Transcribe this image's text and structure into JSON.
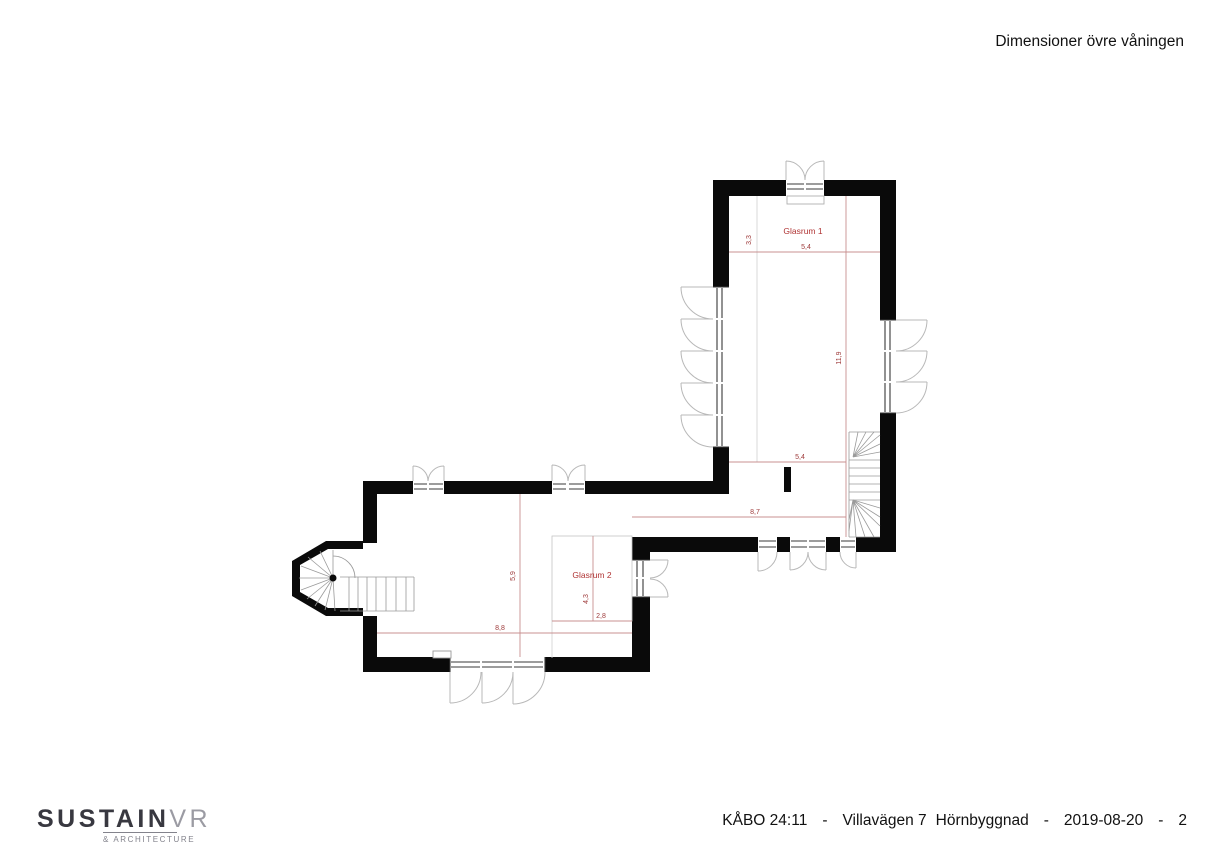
{
  "title": {
    "text": "Dimensioner övre våningen"
  },
  "logo": {
    "primary": "SUSTAIN",
    "secondary": "VR",
    "tagline": "& ARCHITECTURE"
  },
  "footer": {
    "project": "KÅBO 24:11",
    "separator": "-",
    "street": "Villavägen 7",
    "building": "Hörnbyggnad",
    "date": "2019-08-20",
    "page": "2"
  },
  "plan": {
    "rooms": [
      {
        "name": "Glasrum 1"
      },
      {
        "name": "Glasrum 2"
      }
    ],
    "dims": {
      "g1_top_width": "5,4",
      "g1_top_offset": "3,3",
      "g1_length": "11,9",
      "g1_lower_width": "5,4",
      "cross_span": "8,7",
      "west_depth": "5,9",
      "west_width": "8,8",
      "g2_depth": "4,3",
      "g2_width": "2,8"
    },
    "colors": {
      "wall": "#0a0a0a",
      "dimension_line": "#c89090",
      "dimension_text": "#9e3a3a",
      "door_arc": "#b8b8b8",
      "glazing": "#3a3a3a",
      "stair": "#9a9a9a"
    }
  }
}
